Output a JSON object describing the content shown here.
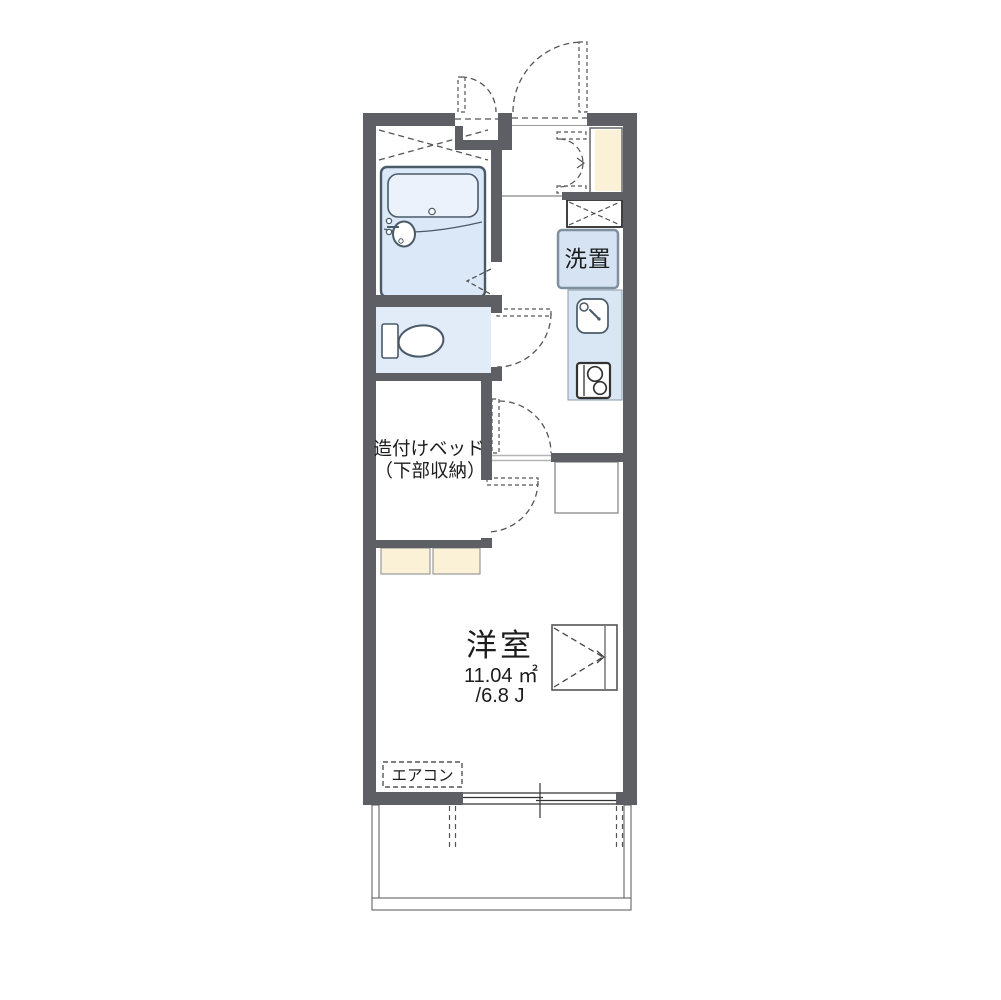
{
  "floorplan": {
    "labels": {
      "washer_space": "洗置",
      "bed_line1": "造付けベッド",
      "bed_line2": "（下部収納）",
      "main_room_name": "洋室",
      "main_room_area_m2": "11.04 ㎡",
      "main_room_area_jo": "/6.8 J",
      "aircon": "エアコン"
    },
    "colors": {
      "wall": "#5e5e65",
      "bath_floor": "#dbe8f7",
      "bathtub": "#ebf2fb",
      "toilet_floor": "#e2ecf9",
      "kitchen_counter": "#d9e6f4",
      "washer_box": "#d5e3f3",
      "cabinet_beige": "#fbf1d7",
      "fixture_line": "#4a5a68",
      "dash_line": "#555555",
      "text": "#1c1c1c"
    }
  }
}
